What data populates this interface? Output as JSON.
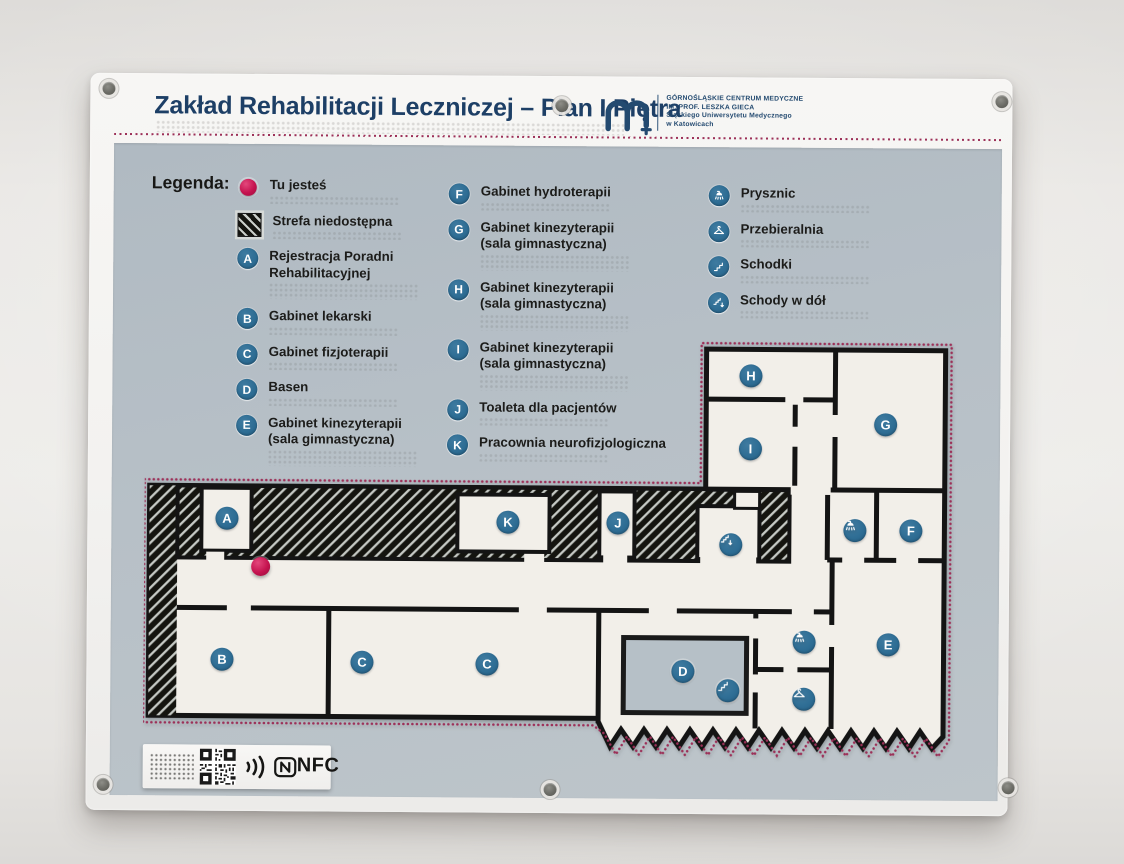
{
  "header": {
    "title": "Zakład Rehabilitacji Leczniczej – Plan I Piętra",
    "logo_lines": [
      "GÓRNOŚLĄSKIE CENTRUM MEDYCZNE",
      "IM. PROF. LESZKA GIECA",
      "Śląskiego Uniwersytetu Medycznego",
      "w Katowicach"
    ]
  },
  "legend": {
    "heading": "Legenda:",
    "columns": [
      [
        {
          "symbol": "dot",
          "label": "Tu jesteś"
        },
        {
          "symbol": "hatch",
          "label": "Strefa niedostępna"
        },
        {
          "symbol": "A",
          "label": "Rejestracja Poradni\nRehabilitacyjnej"
        },
        {
          "symbol": "B",
          "label": "Gabinet lekarski"
        },
        {
          "symbol": "C",
          "label": "Gabinet fizjoterapii"
        },
        {
          "symbol": "D",
          "label": "Basen"
        },
        {
          "symbol": "E",
          "label": "Gabinet kinezyterapii\n(sala gimnastyczna)"
        }
      ],
      [
        {
          "symbol": "F",
          "label": "Gabinet hydroterapii"
        },
        {
          "symbol": "G",
          "label": "Gabinet kinezyterapii\n(sala gimnastyczna)"
        },
        {
          "symbol": "H",
          "label": "Gabinet kinezyterapii\n(sala gimnastyczna)"
        },
        {
          "symbol": "I",
          "label": "Gabinet kinezyterapii\n(sala gimnastyczna)"
        },
        {
          "symbol": "J",
          "label": "Toaleta dla pacjentów"
        },
        {
          "symbol": "K",
          "label": "Pracownia neurofizjologiczna"
        }
      ],
      [
        {
          "symbol": "shower",
          "label": "Prysznic"
        },
        {
          "symbol": "hanger",
          "label": "Przebieralnia"
        },
        {
          "symbol": "stairs",
          "label": "Schodki"
        },
        {
          "symbol": "stairs-down",
          "label": "Schody w dół"
        }
      ]
    ]
  },
  "map": {
    "you_are_here": {
      "x": 117,
      "y": 234
    },
    "letters": [
      {
        "t": "A",
        "x": 83,
        "y": 186
      },
      {
        "t": "K",
        "x": 364,
        "y": 188
      },
      {
        "t": "J",
        "x": 474,
        "y": 188
      },
      {
        "t": "H",
        "x": 606,
        "y": 40
      },
      {
        "t": "I",
        "x": 606,
        "y": 113
      },
      {
        "t": "G",
        "x": 741,
        "y": 88
      },
      {
        "t": "F",
        "x": 767,
        "y": 194
      },
      {
        "t": "B",
        "x": 79,
        "y": 327
      },
      {
        "t": "C",
        "x": 219,
        "y": 329
      },
      {
        "t": "C",
        "x": 344,
        "y": 330
      },
      {
        "t": "D",
        "x": 540,
        "y": 336
      },
      {
        "t": "E",
        "x": 745,
        "y": 308
      }
    ],
    "icons": [
      {
        "t": "stairs-down",
        "x": 587,
        "y": 209
      },
      {
        "t": "shower",
        "x": 711,
        "y": 194
      },
      {
        "t": "shower",
        "x": 661,
        "y": 306
      },
      {
        "t": "hanger",
        "x": 661,
        "y": 363
      },
      {
        "t": "stairs",
        "x": 585,
        "y": 355
      }
    ]
  },
  "footer": {
    "nfc_text": "NFC"
  },
  "colors": {
    "accent_blue": "#2e6d94",
    "dot_red": "#c5134f",
    "outline_pink": "#9c3058",
    "title_navy": "#1d3f66",
    "panel_gray_blue": "#b7c0c7",
    "wall_black": "#141414",
    "plan_white": "#f2efe9"
  }
}
